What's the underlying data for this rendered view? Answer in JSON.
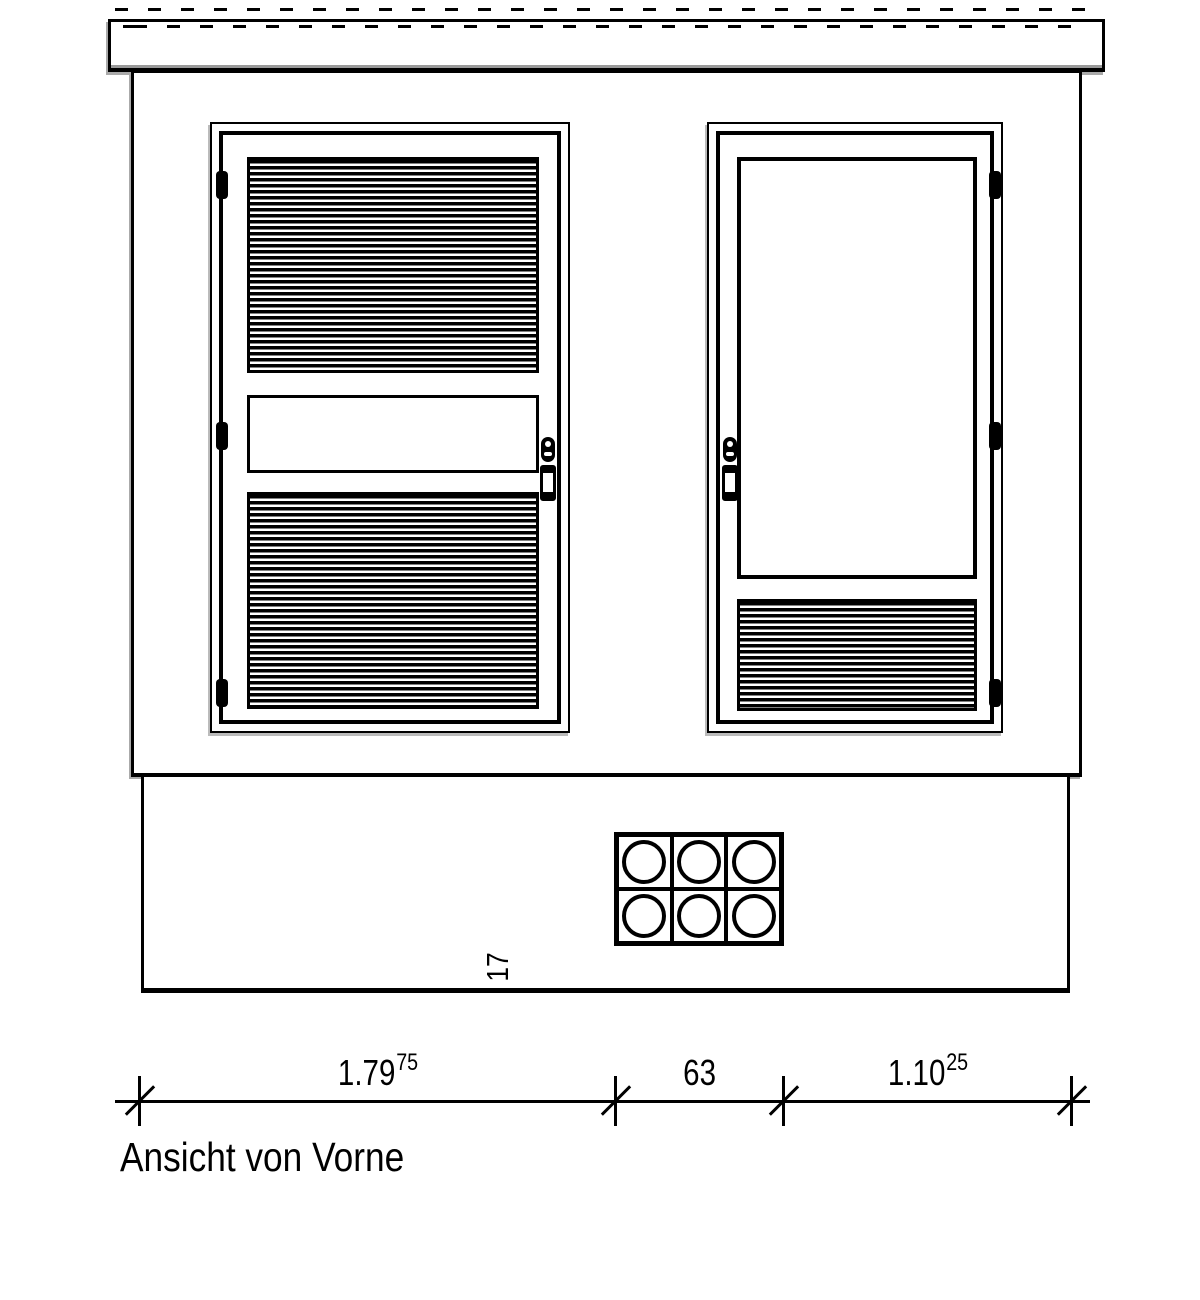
{
  "title": "Ansicht von Vorne",
  "dim": {
    "segments": [
      {
        "value": "1.79",
        "sup": "75"
      },
      {
        "value": "63",
        "sup": ""
      },
      {
        "value": "1.10",
        "sup": "25"
      }
    ],
    "height": {
      "value": "17"
    }
  },
  "colors": {
    "line": "#000000",
    "background": "#ffffff",
    "shadow": "#aaaaaa"
  }
}
